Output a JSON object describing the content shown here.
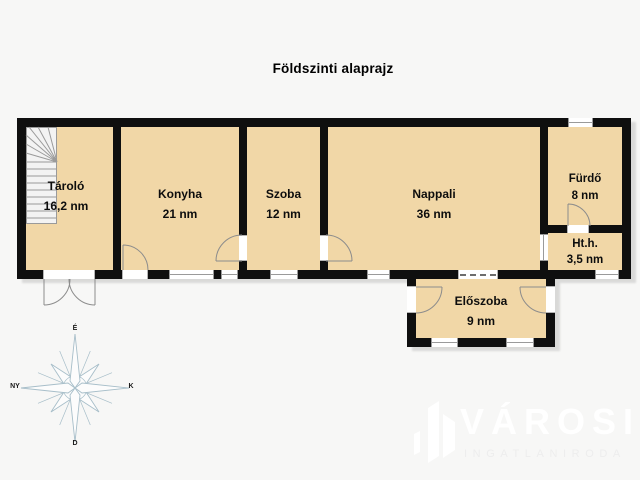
{
  "title": "Földszinti alaprajz",
  "rooms": [
    {
      "name": "Tároló",
      "area": "16,2 nm"
    },
    {
      "name": "Konyha",
      "area": "21 nm"
    },
    {
      "name": "Szoba",
      "area": "12 nm"
    },
    {
      "name": "Nappali",
      "area": "36 nm"
    },
    {
      "name": "Fürdő",
      "area": "8 nm"
    },
    {
      "name": "Ht.h.",
      "area": "3,5 nm"
    },
    {
      "name": "Előszoba",
      "area": "9 nm"
    }
  ],
  "compass": {
    "north": "É",
    "east": "K",
    "south": "D",
    "west": "NY"
  },
  "watermark": {
    "brand": "VÁROSI",
    "subtitle": "INGATLANIRODA"
  },
  "colors": {
    "background": "#f7f7f6",
    "wall": "#0f0f0f",
    "room_fill": "#f1d7a7",
    "door_line": "#8c8c8c",
    "window_frame": "#9a9a9a",
    "compass": "#a7bec9",
    "watermark": "#ffffff"
  }
}
